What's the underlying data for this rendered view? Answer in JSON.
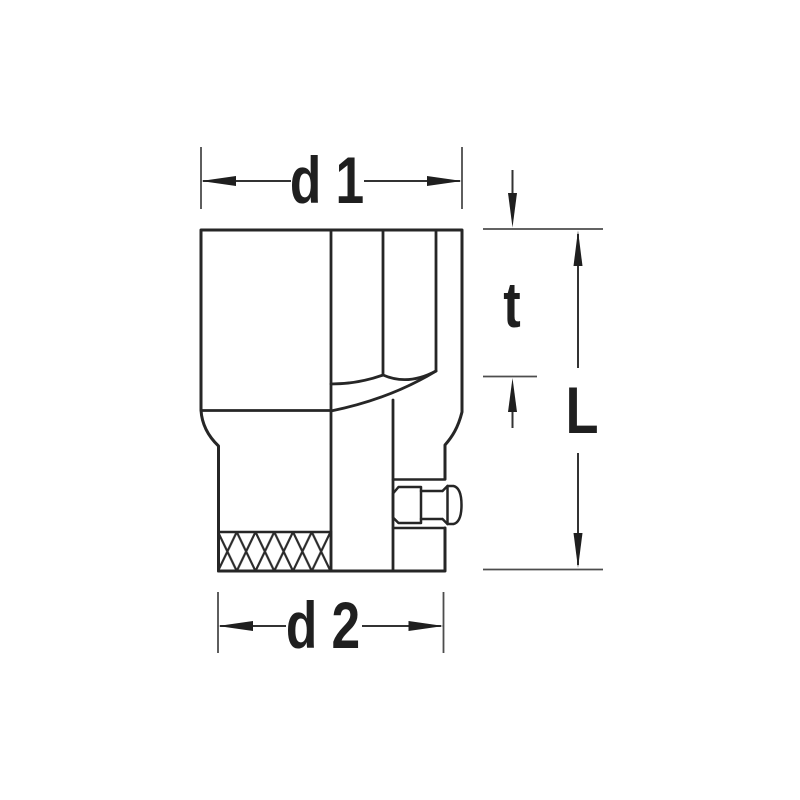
{
  "diagram": {
    "kind": "technical-dimension-drawing",
    "labels": {
      "top_width": "d 1",
      "bottom_width": "d 2",
      "insert_depth": "t",
      "total_length": "L"
    },
    "colors": {
      "background": "#ffffff",
      "line": "#262626",
      "dimension_line": "#333333",
      "extension_line": "#4d4d4d",
      "text": "#1f1f1f"
    }
  }
}
